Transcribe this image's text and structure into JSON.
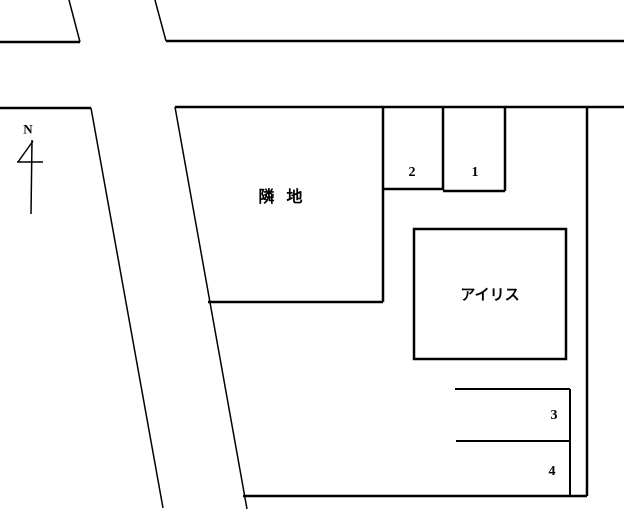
{
  "colors": {
    "line": "#000000",
    "background": "#ffffff"
  },
  "compass": {
    "label": "N"
  },
  "parcels": {
    "adjacent_land": {
      "label": "隣  地"
    },
    "building": {
      "label": "アイリス"
    }
  },
  "parking_spaces": [
    {
      "number": "1"
    },
    {
      "number": "2"
    },
    {
      "number": "3"
    },
    {
      "number": "4"
    }
  ]
}
